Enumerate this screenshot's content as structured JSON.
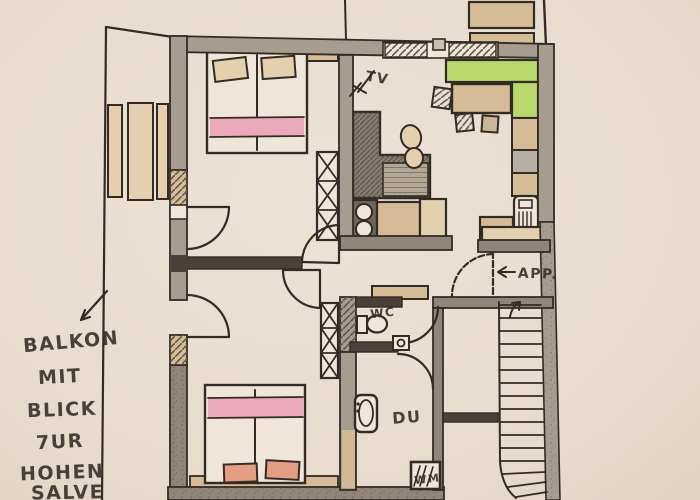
{
  "annotation": {
    "balcony_note": {
      "lines": [
        "BALKON",
        "MIT",
        "BLICK",
        "7UR",
        "HOHEN",
        "SALVE"
      ]
    },
    "tv_label": "TV",
    "apartment_label": "APP.",
    "wc_label": "WC",
    "shower_label": "DU",
    "washer_label": "WM"
  },
  "colors": {
    "paper": "#eae0d2",
    "ink": "#332c25",
    "wall": "#a79d8f",
    "wall_dark": "#8f8678",
    "tan": "#d5bc96",
    "tan_light": "#e4d0ae",
    "pink": "#eba9bc",
    "salmon": "#e59d84",
    "green": "#b9d86d",
    "pencil": "#857c6e",
    "gray": "#b7afa3"
  }
}
